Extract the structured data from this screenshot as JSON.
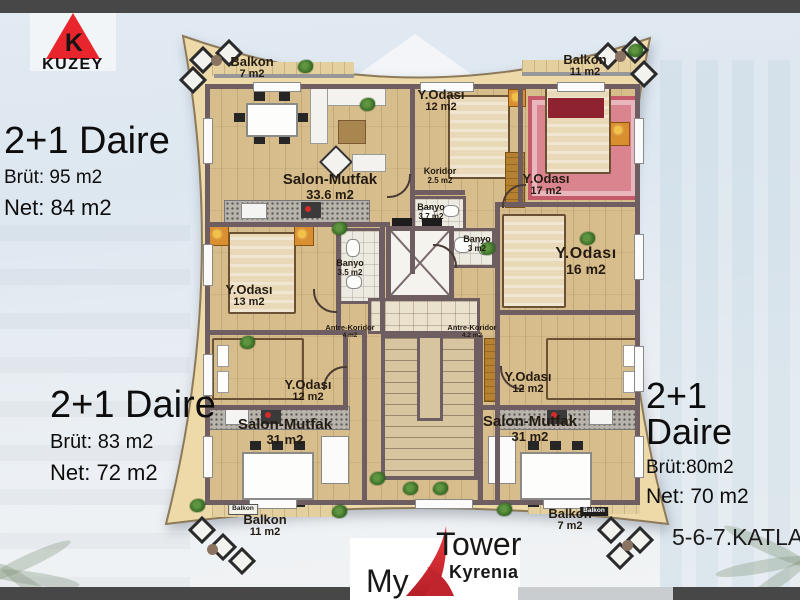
{
  "branding": {
    "north_logo": {
      "letter": "K",
      "name": "KUZEY"
    },
    "logo": {
      "my": "My",
      "tower": "Tower",
      "kyrenia": "Kyrenıa"
    },
    "floors_label": "5-6-7.KATLAR"
  },
  "apartments": {
    "left": {
      "title": "2+1 Daire",
      "brut": "Brüt:  95  m2",
      "net": "Net:  84  m2"
    },
    "bottom_left": {
      "title": "2+1 Daire",
      "brut": "Brüt: 83 m2",
      "net": "Net:   72 m2"
    },
    "right": {
      "title": "2+1 Daire",
      "brut": "Brüt:80m2",
      "net": "Net:   70 m2"
    }
  },
  "plan": {
    "rooms": [
      {
        "name": "Balkon",
        "area": "7 m2"
      },
      {
        "name": "Balkon",
        "area": "11 m2"
      },
      {
        "name": "Y.Odası",
        "area": "12 m2"
      },
      {
        "name": "Y.Odası",
        "area": "17 m2"
      },
      {
        "name": "Salon-Mutfak",
        "area": "33.6 m2"
      },
      {
        "name": "Koridor",
        "area": "2.5 m2"
      },
      {
        "name": "Banyo",
        "area": "3.7 m2"
      },
      {
        "name": "Banyo",
        "area": "3 m2"
      },
      {
        "name": "Y.Odası",
        "area": "16 m2"
      },
      {
        "name": "Y.Odası",
        "area": "13 m2"
      },
      {
        "name": "Banyo",
        "area": "3.5 m2"
      },
      {
        "name": "Antre-Koridor",
        "area": "4 m2"
      },
      {
        "name": "Antre-Koridor",
        "area": "4.2 m2"
      },
      {
        "name": "Y.Odası",
        "area": "12 m2"
      },
      {
        "name": "Y.Odası",
        "area": "12 m2"
      },
      {
        "name": "Salon-Mutfak",
        "area": "31 m2"
      },
      {
        "name": "Salon-Mutfak",
        "area": "31 m2"
      },
      {
        "name": "Balkon",
        "area": "11 m2"
      },
      {
        "name": "Balkon",
        "area": "7 m2"
      }
    ],
    "mini_balcony_labels": {
      "left": "Balkon",
      "right": "Balkon"
    }
  },
  "colors": {
    "accent_red": "#e8252d",
    "plan_beige": "#eed9a8",
    "wall": "#6e5e62",
    "bar_gray": "#474747"
  }
}
